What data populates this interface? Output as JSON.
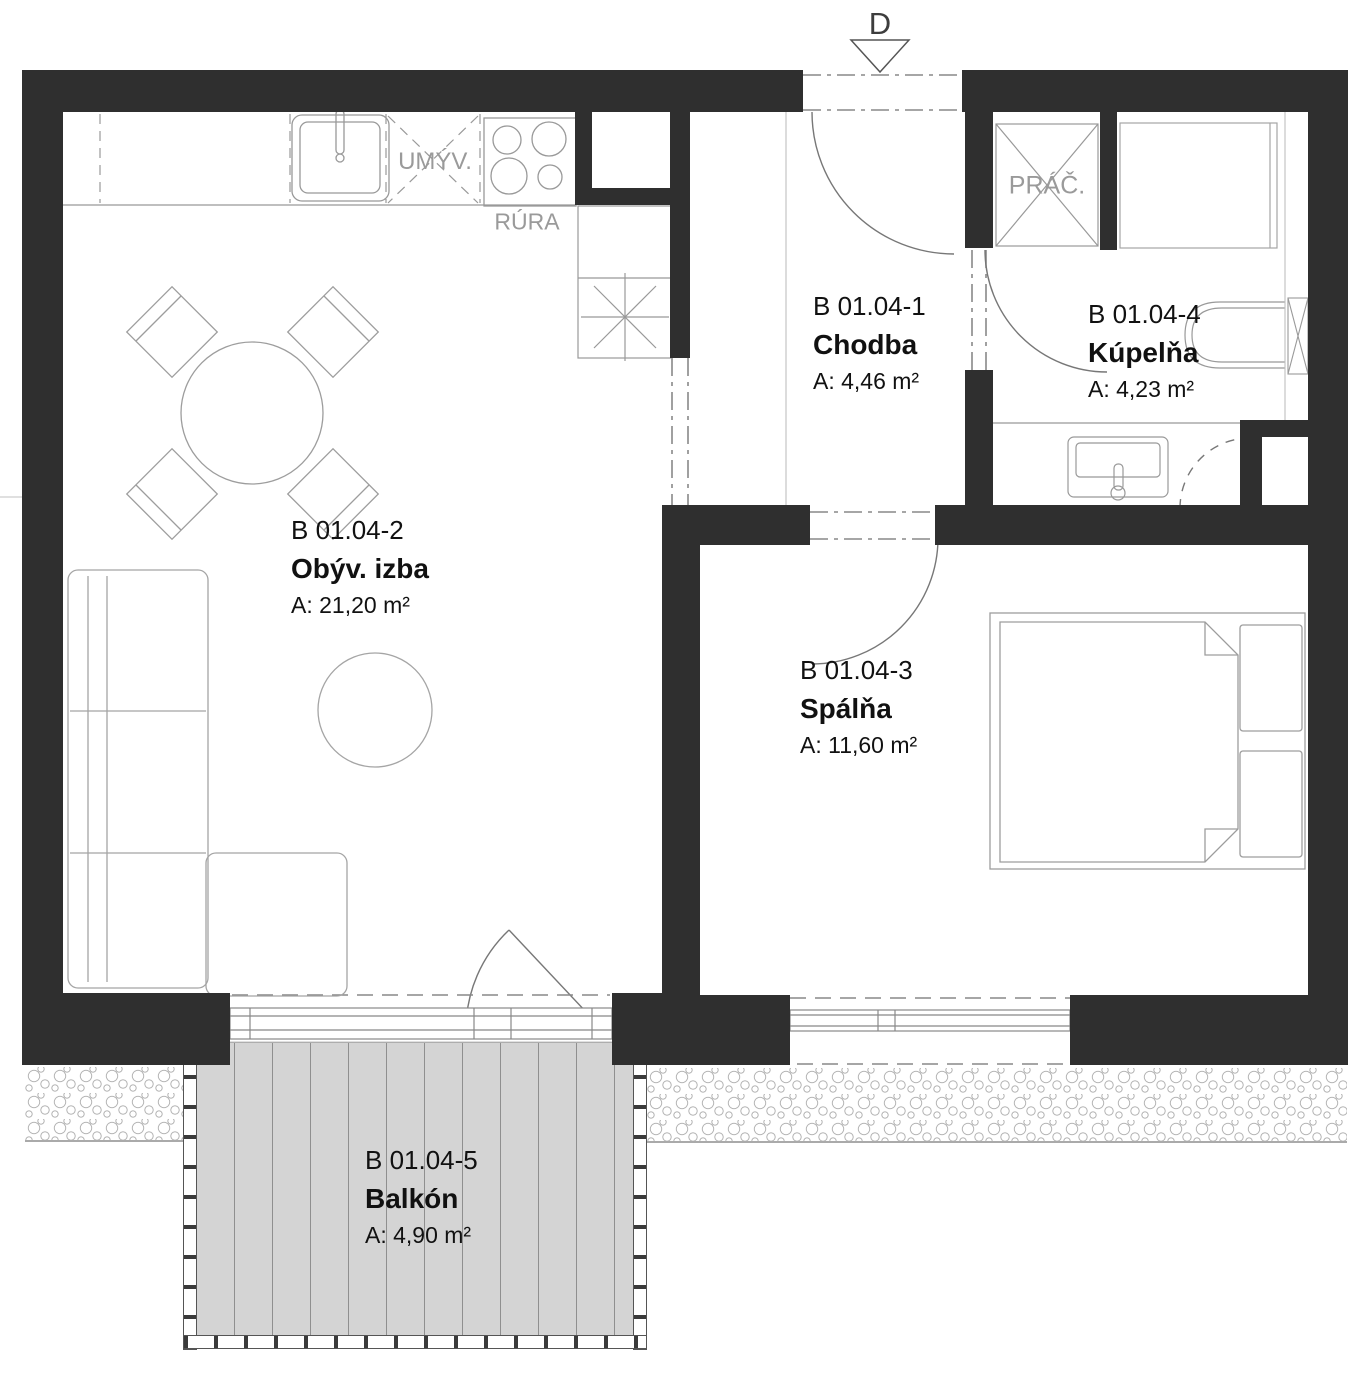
{
  "plan": {
    "entrance": {
      "marker": "D"
    },
    "rooms": [
      {
        "id": "B 01.04-1",
        "name": "Chodba",
        "area": "A: 4,46 m²"
      },
      {
        "id": "B 01.04-2",
        "name": "Obýv. izba",
        "area": "A: 21,20 m²"
      },
      {
        "id": "B 01.04-3",
        "name": "Spálňa",
        "area": "A: 11,60 m²"
      },
      {
        "id": "B 01.04-4",
        "name": "Kúpelňa",
        "area": "A: 4,23 m²"
      },
      {
        "id": "B 01.04-5",
        "name": "Balkón",
        "area": "A: 4,90 m²"
      }
    ],
    "labels": {
      "dishwasher": "UMÝV.",
      "oven": "RÚRA",
      "washer": "PRÁČ."
    },
    "colors": {
      "wall": "#2f2f2f",
      "balcony_fill": "#d4d4d4",
      "outline_gray": "#9a9a9a",
      "text": "#111111"
    }
  }
}
